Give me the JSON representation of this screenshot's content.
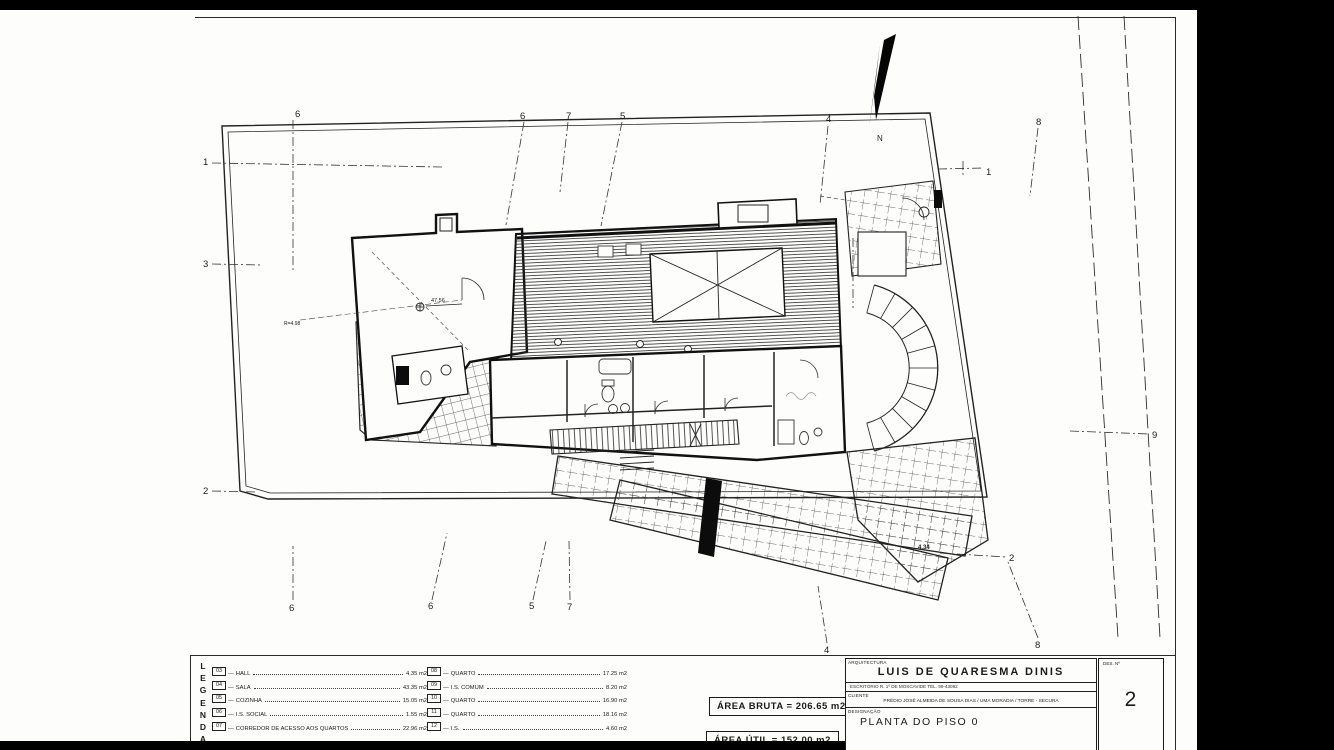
{
  "plan": {
    "north_label": "N",
    "grid_markers": {
      "top": [
        "6",
        "6",
        "7",
        "5",
        "4",
        "8"
      ],
      "left": [
        "1",
        "3",
        "2"
      ],
      "right": [
        "1",
        "9",
        "2"
      ],
      "bottom": [
        "6",
        "6",
        "5",
        "7",
        "4",
        "8"
      ]
    },
    "annotations": {
      "level_point": "47.56",
      "radius_note": "R=4.98",
      "level_point_2": "4.34"
    }
  },
  "legend": {
    "letters": [
      "L",
      "E",
      "G",
      "E",
      "N",
      "D",
      "A"
    ],
    "separator": "—",
    "items_left": [
      {
        "code": "03",
        "name": "HALL",
        "area": "4.35 m2"
      },
      {
        "code": "04",
        "name": "SALA",
        "area": "43.35 m2"
      },
      {
        "code": "05",
        "name": "COZINHA",
        "area": "15.05 m2"
      },
      {
        "code": "06",
        "name": "I.S. SOCIAL",
        "area": "1.55 m2"
      },
      {
        "code": "07",
        "name": "CORREDOR DE ACESSO AOS QUARTOS",
        "area": "22.96 m2"
      }
    ],
    "items_right": [
      {
        "code": "08",
        "name": "QUARTO",
        "area": "17.25 m2"
      },
      {
        "code": "09",
        "name": "I.S. COMUM",
        "area": "8.20 m2"
      },
      {
        "code": "10",
        "name": "QUARTO",
        "area": "16.90 m2"
      },
      {
        "code": "11",
        "name": "QUARTO",
        "area": "18.16 m2"
      },
      {
        "code": "12",
        "name": "I.S.",
        "area": "4.60 m2"
      }
    ]
  },
  "areas": {
    "bruta": "ÁREA BRUTA = 206.65 m2",
    "util": "ÁREA ÚTIL = 152.00 m2"
  },
  "title_block": {
    "discipline_label": "ARQUITECTURA",
    "architect_name": "LUIS DE QUARESMA DINIS",
    "office_line": "ESCRITÓRIO  R. 1º DE MOSCAVIDE   TEL. 99-43092",
    "client_label": "CLIENTE",
    "client_line": "PRÉDIO JOSÉ ALMEIDA DE SOUSA DIAS / UMA MORADIA / TORRE - SECURA",
    "designation_label": "DESIGNAÇÃO",
    "designation": "PLANTA DO PISO 0",
    "sheet_label": "DES. Nº",
    "sheet_number": "2"
  }
}
